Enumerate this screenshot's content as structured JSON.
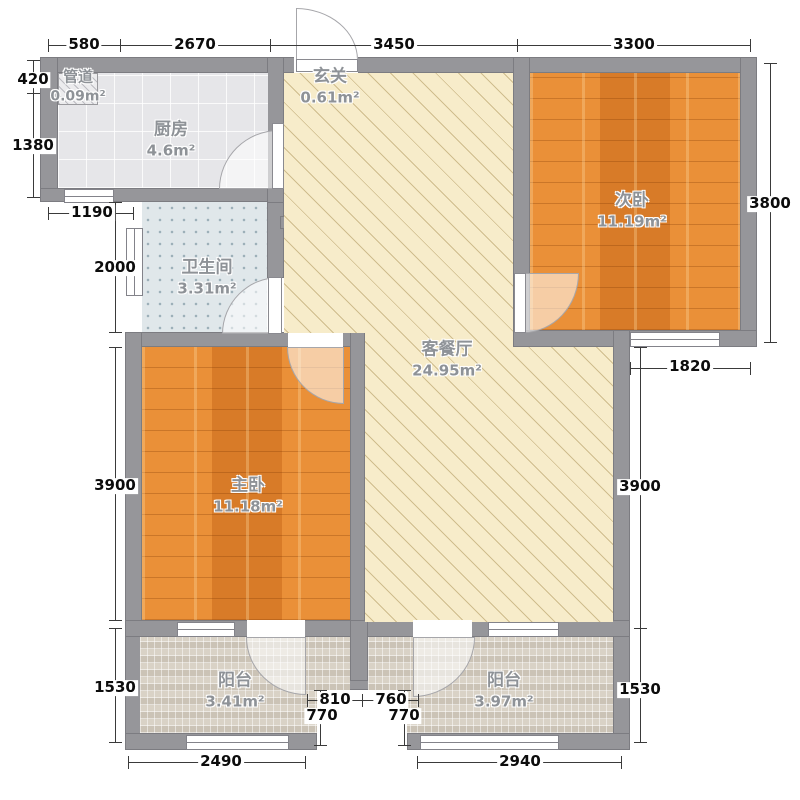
{
  "plan_title": "two-bedroom apartment floor plan",
  "rooms": {
    "duct": {
      "name": "管道",
      "area": "0.09m²"
    },
    "kitchen": {
      "name": "厨房",
      "area": "4.6m²"
    },
    "entry": {
      "name": "玄关",
      "area": "0.61m²"
    },
    "bedroom2": {
      "name": "次卧",
      "area": "11.19m²"
    },
    "bathroom": {
      "name": "卫生间",
      "area": "3.31m²"
    },
    "living": {
      "name": "客餐厅",
      "area": "24.95m²"
    },
    "bedroom1": {
      "name": "主卧",
      "area": "11.18m²"
    },
    "balcony_left": {
      "name": "阳台",
      "area": "3.41m²"
    },
    "balcony_right": {
      "name": "阳台",
      "area": "3.97m²"
    }
  },
  "dimensions": {
    "top": [
      "580",
      "2670",
      "3450",
      "3300"
    ],
    "left": [
      "420",
      "1380",
      "1190",
      "2000",
      "3900",
      "1530"
    ],
    "right": [
      "3800",
      "1820",
      "3900",
      "1530"
    ],
    "bottom": [
      "2490",
      "2940"
    ],
    "notch": [
      "810",
      "760",
      "770",
      "770"
    ]
  },
  "colors": {
    "wall": "#96969a",
    "wood_floor": "#e2862f",
    "living_floor": "#f7ecca",
    "kitchen_floor": "#e6e6e9",
    "bathroom_floor": "#e0e7ea",
    "balcony_floor": "#d9d2c6",
    "dimension_text": "#0c0c0c",
    "room_label": "#8e9297"
  }
}
